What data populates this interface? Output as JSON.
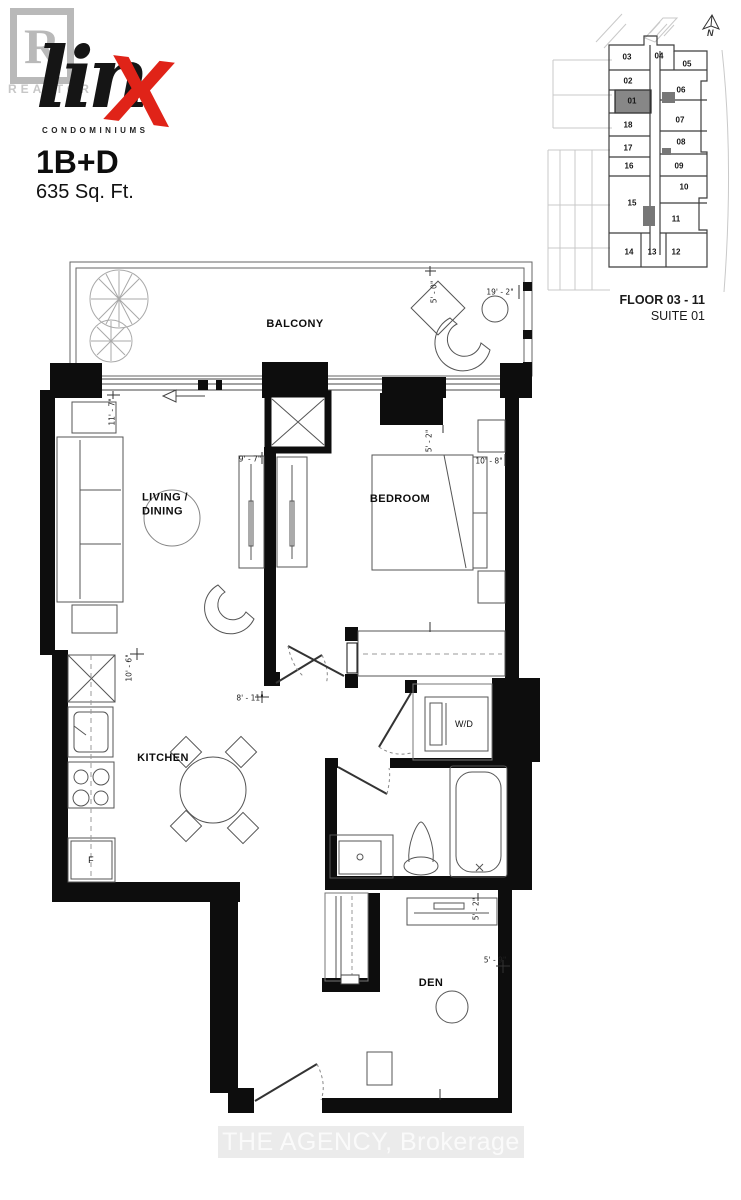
{
  "header": {
    "realtor_r": "R",
    "realtor_word": "REALTOR",
    "brand_script": "lin",
    "brand_x": "X",
    "brand_sub": "CONDOMINIUMS",
    "unit_type": "1B+D",
    "area": "635 Sq. Ft."
  },
  "keyplan": {
    "north": "N",
    "floor_label": "FLOOR 03 - 11",
    "suite_label": "SUITE 01",
    "highlighted_suite": "01",
    "suites": [
      "03",
      "04",
      "05",
      "02",
      "01",
      "06",
      "18",
      "07",
      "17",
      "08",
      "16",
      "09",
      "15",
      "10",
      "11",
      "14",
      "13",
      "12"
    ]
  },
  "plan": {
    "rooms": {
      "balcony": "BALCONY",
      "living_line1": "LIVING /",
      "living_line2": "DINING",
      "bedroom": "BEDROOM",
      "kitchen": "KITCHEN",
      "wd": "W/D",
      "den": "DEN",
      "fridge": "F"
    },
    "dims": {
      "balcony_w": "19' - 2\"",
      "balcony_d": "5' - 0\"",
      "living_h": "11' - 7\"",
      "closet_w": "9' - 7\"",
      "bedroom_w": "10' - 8\"",
      "bedroom_nook": "5' - 2\"",
      "kitchen_h": "10' - 6\"",
      "hall_w": "8' - 11\"",
      "den_desk": "5' - 2\"",
      "den_w": "5' - 9\""
    }
  },
  "watermark": "THE AGENCY, Brokerage",
  "colors": {
    "accent_red": "#e02318",
    "wall_black": "#0d0d0d",
    "highlight_gray": "#878787"
  }
}
